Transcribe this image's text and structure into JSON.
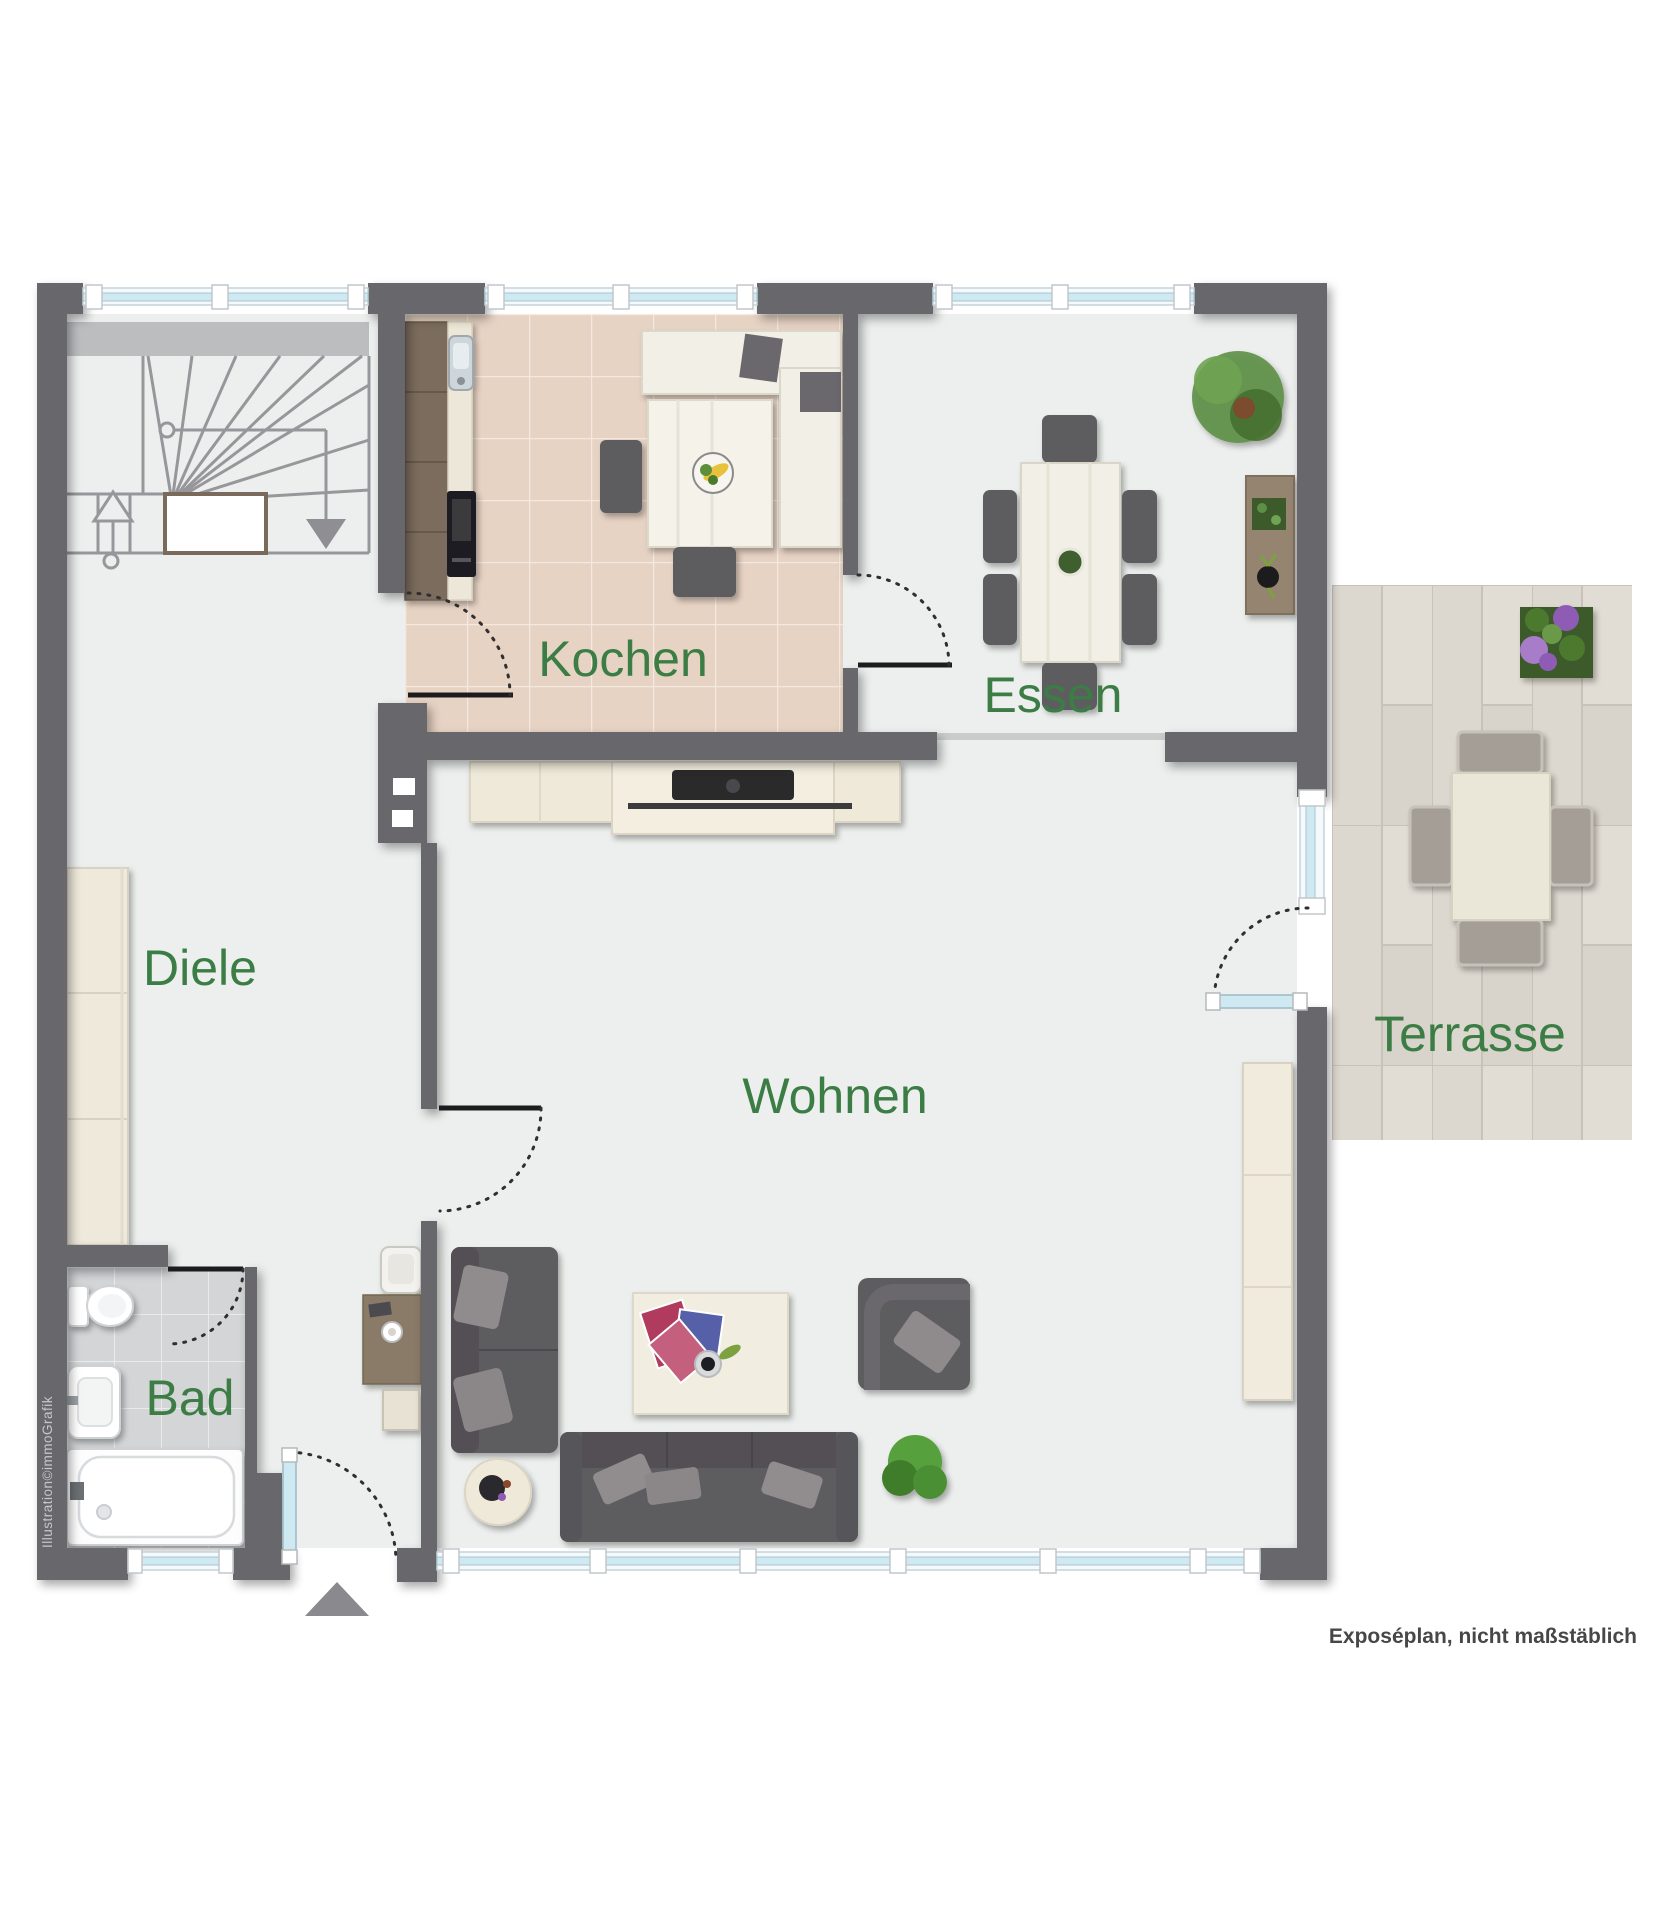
{
  "meta": {
    "caption": "Exposéplan, nicht maßstäblich",
    "credit": "Illustration©immoGrafik"
  },
  "rooms": [
    {
      "id": "kochen",
      "label": "Kochen"
    },
    {
      "id": "essen",
      "label": "Essen"
    },
    {
      "id": "diele",
      "label": "Diele"
    },
    {
      "id": "wohnen",
      "label": "Wohnen"
    },
    {
      "id": "bad",
      "label": "Bad"
    },
    {
      "id": "terrasse",
      "label": "Terrasse"
    }
  ],
  "palette": {
    "wall": "#67676c",
    "floor": "#ecefed",
    "kitchen_tile": "#e7d3c4",
    "bath_tile": "#d3d5d7",
    "terrace_plank": "#ddd8cf",
    "window_glass": "#cfe9f2",
    "label_green": "#3b7d45",
    "furniture_dark": "#5d5b5f",
    "wood_light": "#efe9da",
    "wood_brown": "#8a7a68"
  },
  "furniture": {
    "diele": [
      "staircase-with-direction-arrows",
      "wardrobe",
      "desk",
      "desk-chair",
      "stool"
    ],
    "kochen": [
      "kitchen-cabinets",
      "sink",
      "oven",
      "corner-bench",
      "nook-table",
      "fruit-bowl",
      "two-chairs"
    ],
    "essen": [
      "dining-table",
      "six-chairs",
      "potted-plant",
      "sideboard-with-planter-and-vase"
    ],
    "wohnen": [
      "tv-sideboard",
      "tv",
      "two-seat-sofa",
      "three-seat-sofa",
      "armchair",
      "coffee-table",
      "round-side-table",
      "plant",
      "highboard"
    ],
    "bad": [
      "toilet",
      "washbasin",
      "bathtub"
    ],
    "terrasse": [
      "garden-table",
      "four-garden-chairs",
      "flower-planter"
    ]
  }
}
